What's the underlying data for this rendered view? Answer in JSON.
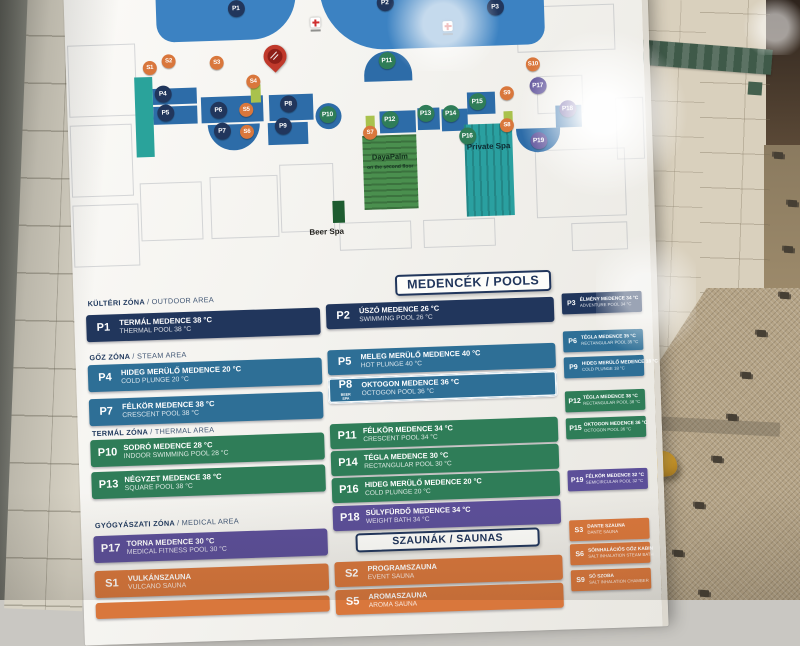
{
  "palette": {
    "navy": "#21365c",
    "blue": "#2e6f96",
    "green": "#2f7d58",
    "purple": "#5c4f99",
    "orange": "#d9773c",
    "pool_light": "#3c82c2",
    "pool_dark": "#2d6ca8",
    "lime": "#a9c24d",
    "teal": "#2aa39b",
    "red": "#c0392b"
  },
  "map": {
    "labels": {
      "dayspa": "DayaPalm",
      "dayspa_sub": "on the second floor",
      "private_spa": "Private Spa",
      "beer_spa": "Beer Spa"
    },
    "icons": {
      "pin": "you-are-here-pin-icon",
      "cross": "first-aid-cross-icon"
    },
    "markers": [
      {
        "code": "P1",
        "color": "navy",
        "x": 172,
        "y": 18
      },
      {
        "code": "P2",
        "color": "navy",
        "x": 321,
        "y": 17
      },
      {
        "code": "P3",
        "color": "navy",
        "x": 431,
        "y": 25
      },
      {
        "code": "P4",
        "color": "navy",
        "x": 96,
        "y": 101
      },
      {
        "code": "P5",
        "color": "navy",
        "x": 98,
        "y": 120
      },
      {
        "code": "P6",
        "color": "navy",
        "x": 151,
        "y": 119
      },
      {
        "code": "P7",
        "color": "navy",
        "x": 154,
        "y": 140
      },
      {
        "code": "P8",
        "color": "navy",
        "x": 221,
        "y": 115
      },
      {
        "code": "P9",
        "color": "navy",
        "x": 215,
        "y": 137
      },
      {
        "code": "P10",
        "color": "green",
        "x": 260,
        "y": 127
      },
      {
        "code": "P11",
        "color": "green",
        "x": 321,
        "y": 75
      },
      {
        "code": "P12",
        "color": "green",
        "x": 322,
        "y": 134
      },
      {
        "code": "P13",
        "color": "green",
        "x": 358,
        "y": 129
      },
      {
        "code": "P14",
        "color": "green",
        "x": 383,
        "y": 130
      },
      {
        "code": "P15",
        "color": "green",
        "x": 410,
        "y": 119
      },
      {
        "code": "P16",
        "color": "green",
        "x": 399,
        "y": 153
      },
      {
        "code": "P17",
        "color": "purple",
        "x": 471,
        "y": 105
      },
      {
        "code": "P18",
        "color": "purple",
        "x": 500,
        "y": 129
      },
      {
        "code": "P19",
        "color": "purple",
        "x": 470,
        "y": 160
      },
      {
        "code": "S1",
        "color": "orange",
        "x": 84,
        "y": 75
      },
      {
        "code": "S2",
        "color": "orange",
        "x": 103,
        "y": 69
      },
      {
        "code": "S3",
        "color": "orange",
        "x": 151,
        "y": 72
      },
      {
        "code": "S4",
        "color": "orange",
        "x": 187,
        "y": 92
      },
      {
        "code": "S5",
        "color": "orange",
        "x": 179,
        "y": 120
      },
      {
        "code": "S6",
        "color": "orange",
        "x": 179,
        "y": 142
      },
      {
        "code": "S7",
        "color": "orange",
        "x": 302,
        "y": 147
      },
      {
        "code": "S8",
        "color": "orange",
        "x": 439,
        "y": 144
      },
      {
        "code": "S9",
        "color": "orange",
        "x": 440,
        "y": 112
      },
      {
        "code": "S10",
        "color": "orange",
        "x": 467,
        "y": 84
      }
    ]
  },
  "legend": {
    "pools_title": "MEDENCÉK / POOLS",
    "saunas_title": "SZAUNÁK / SAUNAS",
    "columns": [
      [
        {
          "kind": "header",
          "top": 14,
          "text": "KÜLTÉRI ZÓNA / OUTDOOR AREA"
        },
        {
          "kind": "chip",
          "top": 30,
          "code": "P1",
          "hu": "TERMÁL MEDENCE 38 °C",
          "en": "THERMAL POOL 38 °C",
          "color": "navy"
        },
        {
          "kind": "header",
          "top": 68,
          "text": "GŐZ ZÓNA / STEAM AREA"
        },
        {
          "kind": "chip",
          "top": 80,
          "code": "P4",
          "hu": "HIDEG MERÜLŐ MEDENCE 20 °C",
          "en": "COLD PLUNGE 20 °C",
          "color": "blue"
        },
        {
          "kind": "chip",
          "top": 114,
          "code": "P7",
          "hu": "FÉLKÖR MEDENCE 38 °C",
          "en": "CRESCENT POOL 38 °C",
          "color": "blue"
        },
        {
          "kind": "header",
          "top": 144,
          "text": "TERMÁL ZÓNA / THERMAL AREA"
        },
        {
          "kind": "chip",
          "top": 155,
          "code": "P10",
          "hu": "SODRÓ MEDENCE 28 °C",
          "en": "INDOOR SWIMMING POOL 28 °C",
          "color": "green"
        },
        {
          "kind": "chip",
          "top": 187,
          "code": "P13",
          "hu": "NÉGYZET MEDENCE 38 °C",
          "en": "SQUARE POOL 38 °C",
          "color": "green"
        },
        {
          "kind": "header",
          "top": 236,
          "text": "GYÓGYÁSZATI ZÓNA / MEDICAL AREA"
        },
        {
          "kind": "chip",
          "top": 251,
          "code": "P17",
          "hu": "TORNA MEDENCE 30 °C",
          "en": "MEDICAL FITNESS POOL 30 °C",
          "color": "purple"
        },
        {
          "kind": "chip",
          "top": 286,
          "code": "S1",
          "hu": "VULKÁNSZAUNA",
          "en": "VULCANO SAUNA",
          "color": "orange"
        },
        {
          "kind": "chip",
          "top": 318,
          "code": "",
          "hu": "",
          "en": "",
          "color": "orange",
          "partial": true
        }
      ],
      [
        {
          "kind": "chip",
          "top": 27,
          "code": "P2",
          "hu": "ÚSZÓ MEDENCE 26 °C",
          "en": "SWIMMING POOL 26 °C",
          "color": "navy"
        },
        {
          "kind": "chip",
          "top": 73,
          "code": "P5",
          "hu": "MELEG MERÜLŐ MEDENCE 40 °C",
          "en": "HOT PLUNGE 40 °C",
          "color": "blue"
        },
        {
          "kind": "chip",
          "top": 101,
          "code": "P8",
          "hu": "OKTOGON MEDENCE 36 °C",
          "en": "OCTOGON POOL 36 °C",
          "color": "blue",
          "framed": true,
          "sub": "BEER SPA"
        },
        {
          "kind": "chip",
          "top": 147,
          "code": "P11",
          "hu": "FÉLKÖR MEDENCE 34 °C",
          "en": "CRESCENT POOL 34 °C",
          "color": "green"
        },
        {
          "kind": "chip",
          "top": 174,
          "code": "P14",
          "hu": "TÉGLA MEDENCE 30 °C",
          "en": "RECTANGULAR POOL 30 °C",
          "color": "green"
        },
        {
          "kind": "chip",
          "top": 201,
          "code": "P16",
          "hu": "HIDEG MERÜLŐ MEDENCE 20 °C",
          "en": "COLD PLUNGE 20 °C",
          "color": "green"
        },
        {
          "kind": "chip",
          "top": 229,
          "code": "P18",
          "hu": "SÚLYFÜRDŐ MEDENCE 34 °C",
          "en": "WEIGHT BATH 34 °C",
          "color": "purple"
        },
        {
          "kind": "title",
          "top": 257
        },
        {
          "kind": "chip",
          "top": 285,
          "code": "S2",
          "hu": "PROGRAMSZAUNA",
          "en": "EVENT SAUNA",
          "color": "orange"
        },
        {
          "kind": "chip",
          "top": 313,
          "code": "S5",
          "hu": "AROMASZAUNA",
          "en": "AROMA SAUNA",
          "color": "orange"
        }
      ],
      [
        {
          "kind": "chip",
          "top": 24,
          "code": "P3",
          "hu": "ÉLMÉNY MEDENCE 34 °C",
          "en": "ADVENTURE POOL 34 °C",
          "color": "navy"
        },
        {
          "kind": "chip",
          "top": 62,
          "code": "P6",
          "hu": "TÉGLA MEDENCE 35 °C",
          "en": "RECTANGULAR POOL 35 °C",
          "color": "blue"
        },
        {
          "kind": "chip",
          "top": 88,
          "code": "P9",
          "hu": "HIDEG MERÜLŐ MEDENCE 18 °C",
          "en": "COLD PLUNGE 18 °C",
          "color": "blue"
        },
        {
          "kind": "chip",
          "top": 122,
          "code": "P12",
          "hu": "TÉGLA MEDENCE 38 °C",
          "en": "RECTANGULAR POOL 38 °C",
          "color": "green"
        },
        {
          "kind": "chip",
          "top": 149,
          "code": "P15",
          "hu": "OKTOGON MEDENCE 36 °C",
          "en": "OCTOGON POOL 36 °C",
          "color": "green"
        },
        {
          "kind": "chip",
          "top": 201,
          "code": "P19",
          "hu": "FÉLKÖR MEDENCE 32 °C",
          "en": "SEMICIRCULAR POOL 32 °C",
          "color": "purple"
        },
        {
          "kind": "chip",
          "top": 251,
          "code": "S3",
          "hu": "DANTE SZAUNA",
          "en": "DANTE SAUNA",
          "color": "orange"
        },
        {
          "kind": "chip",
          "top": 275,
          "code": "S6",
          "hu": "SÓINHALÁCIÓS GŐZ KABIN",
          "en": "SALT INHALATION STEAM BATH",
          "color": "orange"
        },
        {
          "kind": "chip",
          "top": 301,
          "code": "S9",
          "hu": "SÓ SZOBA",
          "en": "SALT INHALATION CHAMBER",
          "color": "orange"
        }
      ]
    ]
  }
}
